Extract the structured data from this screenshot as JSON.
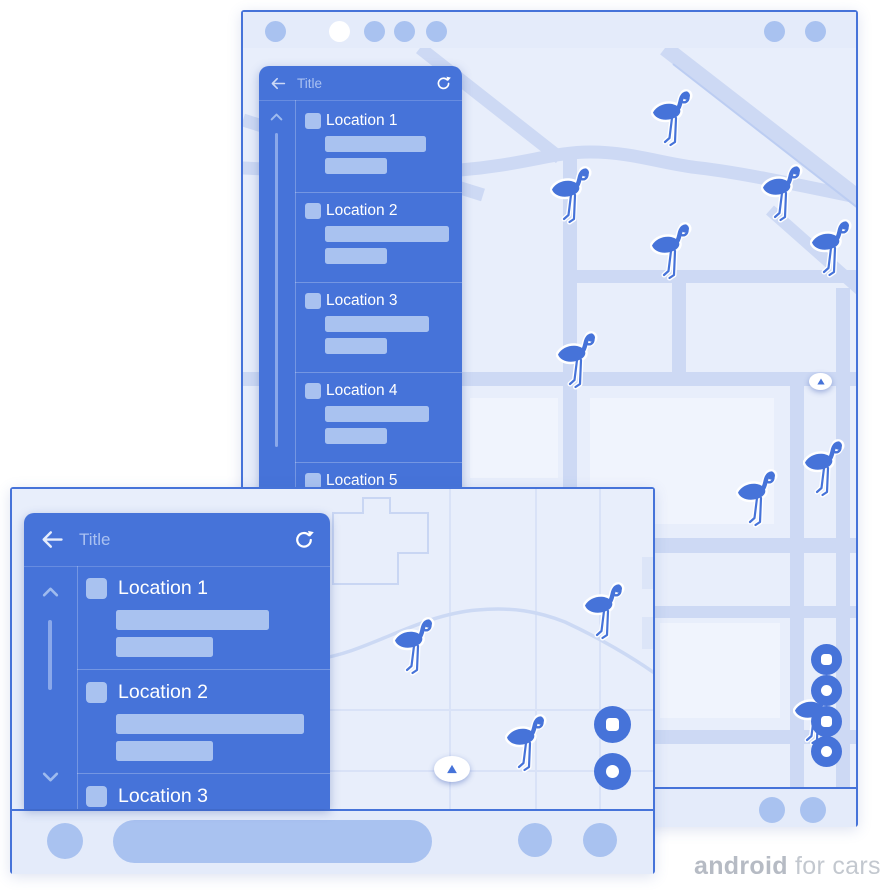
{
  "brand": {
    "name_bold": "android",
    "name_rest": " for cars"
  },
  "colors": {
    "primary_blue": "#4673d9",
    "light_blue": "#a9c2f0",
    "map_background": "#e8eefb",
    "road": "#cdd9f4",
    "bar_background": "#e4ebfa",
    "white": "#ffffff",
    "header_text": "#aac1f1",
    "logo_gray": "#bdc2ca"
  },
  "icons": {
    "back": "arrow-left",
    "refresh": "refresh-arrow",
    "scroll_up": "chevron-up",
    "scroll_down": "chevron-down",
    "compass": "triangle-up",
    "map_marker": "flamingo",
    "action_a": "square",
    "action_b": "circle"
  },
  "portrait_screen": {
    "header": {
      "title": "Title"
    },
    "items": [
      {
        "label": "Location 1"
      },
      {
        "label": "Location 2"
      },
      {
        "label": "Location 3"
      },
      {
        "label": "Location 4"
      },
      {
        "label": "Location 5"
      }
    ],
    "map": {
      "marker_count": 9,
      "action_button_count": 4
    }
  },
  "landscape_screen": {
    "header": {
      "title": "Title"
    },
    "items": [
      {
        "label": "Location 1"
      },
      {
        "label": "Location 2"
      },
      {
        "label": "Location 3"
      }
    ],
    "map": {
      "marker_count": 3,
      "action_button_count": 2
    }
  }
}
